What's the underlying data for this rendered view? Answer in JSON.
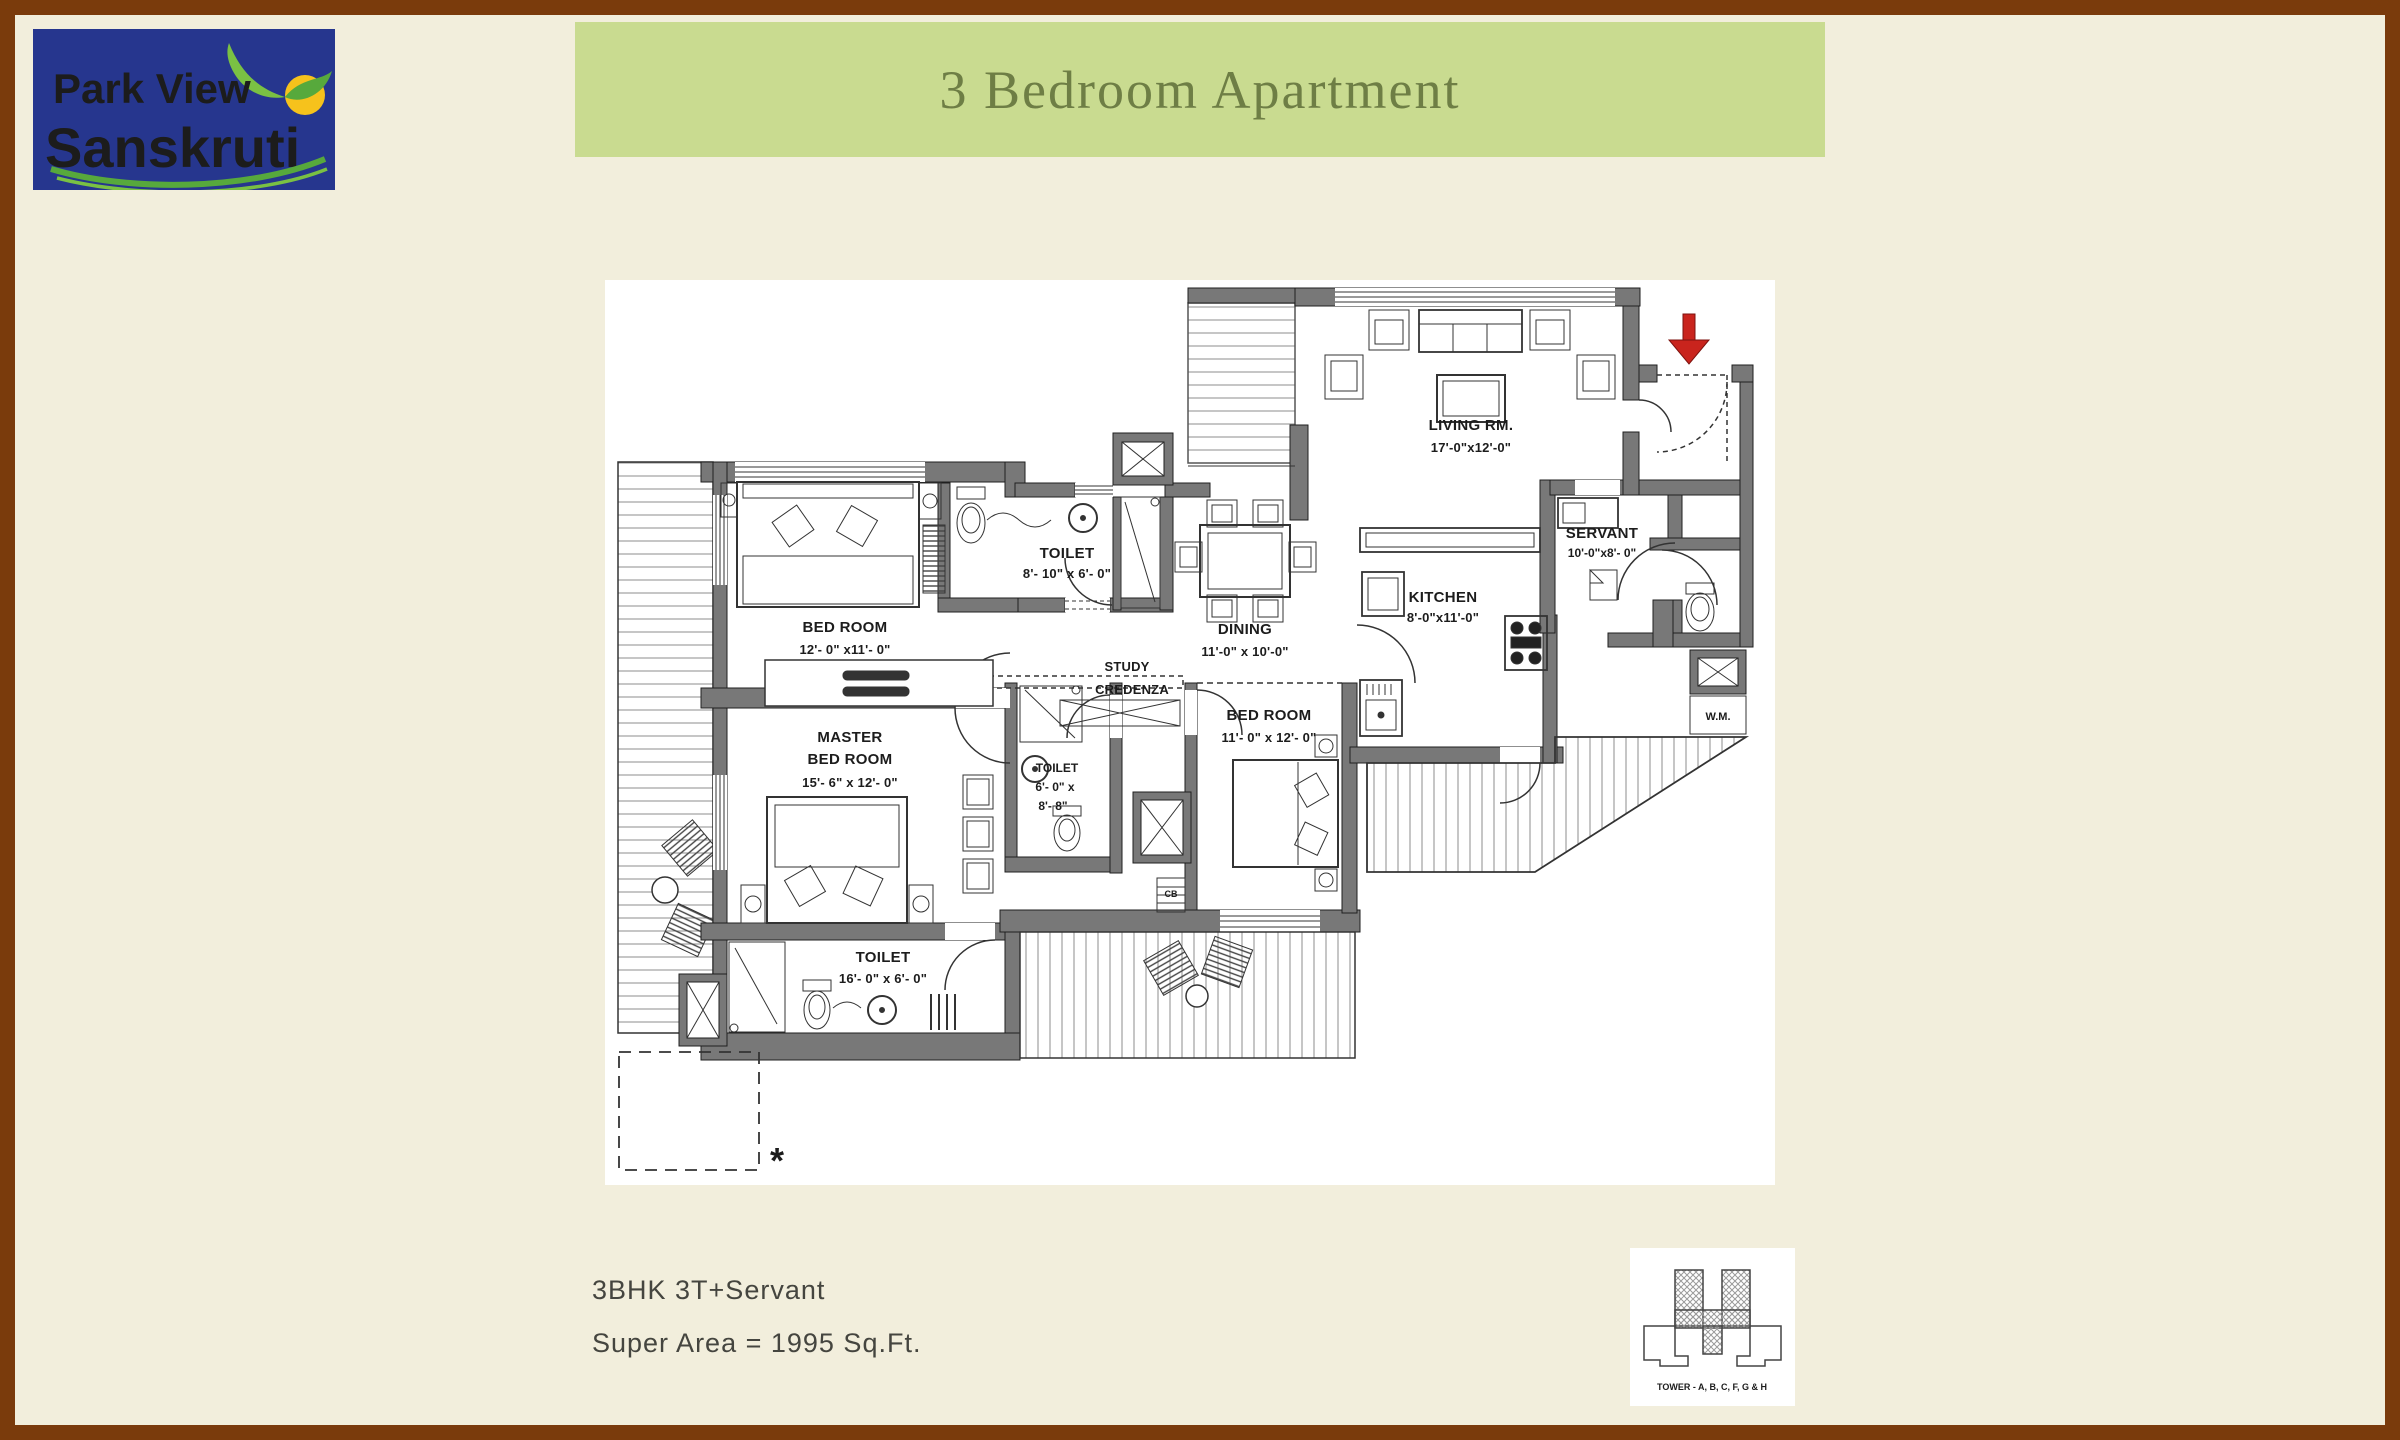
{
  "logo": {
    "line1": "Park View",
    "line2": "Sanskruti"
  },
  "banner": {
    "title": "3 Bedroom Apartment"
  },
  "plan": {
    "rooms": {
      "living": {
        "name": "LIVING RM.",
        "dims": "17'-0\"x12'-0\""
      },
      "dining": {
        "name": "DINING",
        "dims": "11'-0\" x 10'-0\""
      },
      "kitchen": {
        "name": "KITCHEN",
        "dims": "8'-0\"x11'-0\""
      },
      "servant": {
        "name": "SERVANT",
        "dims": "10'-0\"x8'- 0\""
      },
      "bedroom1": {
        "name": "BED ROOM",
        "dims": "12'- 0\" x11'- 0\""
      },
      "master": {
        "name1": "MASTER",
        "name2": "BED ROOM",
        "dims": "15'- 6\" x 12'- 0\""
      },
      "bedroom2": {
        "name": "BED ROOM",
        "dims": "11'- 0\" x 12'- 0\""
      },
      "toilet_common": {
        "name": "TOILET",
        "dims": "8'- 10\" x 6'- 0\""
      },
      "toilet_mid": {
        "name": "TOILET",
        "dims1": "6'- 0\" x",
        "dims2": "8'- 8\""
      },
      "toilet_master": {
        "name": "TOILET",
        "dims": "16'- 0\" x 6'- 0\""
      },
      "study": {
        "line1": "STUDY",
        "line2": "CREDENZA"
      },
      "wm": "W.M.",
      "cb": "CB"
    },
    "note_symbol": "*"
  },
  "footer": {
    "line1": "3BHK 3T+Servant",
    "line2": "Super Area = 1995 Sq.Ft."
  },
  "tower_key": {
    "caption": "TOWER - A, B, C, F, G & H"
  },
  "colors": {
    "frame": "#7a3b0c",
    "page_bg": "#f2eedc",
    "banner_bg": "#c9db90",
    "banner_text": "#6e7e45",
    "logo_bg": "#26368e",
    "logo_line1": "#ffffff",
    "logo_line2": "#f08428",
    "entry_arrow": "#c9241d",
    "wall": "#787878"
  }
}
